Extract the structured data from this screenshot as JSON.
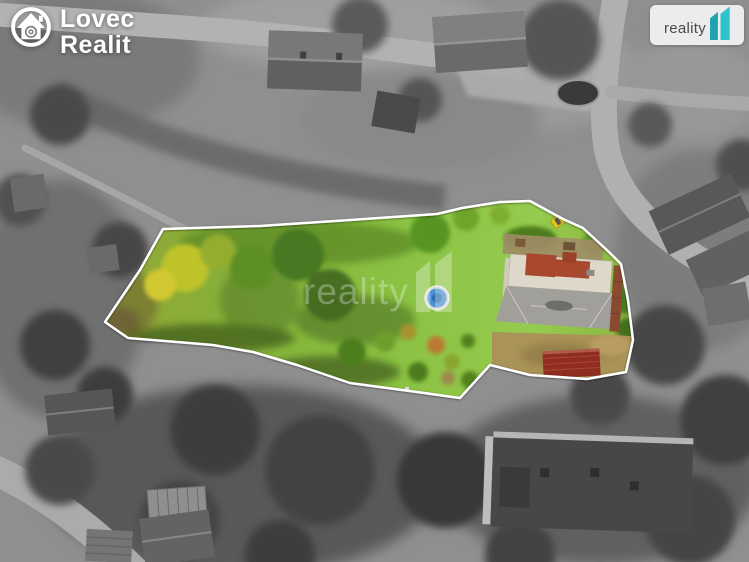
{
  "branding": {
    "agency_logo": {
      "line1": "Lovec",
      "line2": "Realit"
    },
    "portal_badge": {
      "label": "reality"
    },
    "watermark": {
      "label": "reality"
    }
  },
  "icons": {
    "agency_logo_icon": "house-with-lens-in-circle",
    "portal_badge_icon": "reality-double-one",
    "watermark_icon": "reality-double-one"
  },
  "colors": {
    "teal_accent": "#2fc2cc",
    "teal_accent_dark": "#1da3af",
    "property_outline": "#ffffff",
    "lawn_green": "#8abc40",
    "house_roof_gray": "#a09f99",
    "shed_roof_red": "#8e2d20",
    "pool_blue": "#4b8fd0",
    "car_yellow": "#e3c417"
  }
}
